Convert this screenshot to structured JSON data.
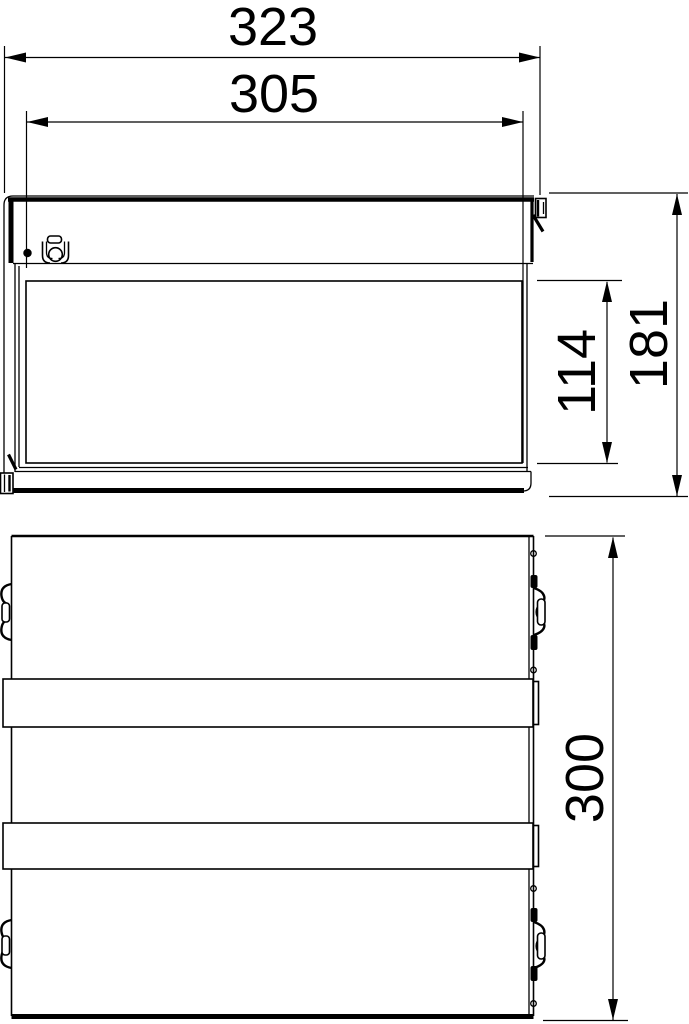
{
  "drawing": {
    "kind": "technical-dimension-drawing",
    "colors": {
      "line": "#000000",
      "background": "#ffffff"
    },
    "views": {
      "front": {
        "dimensions": {
          "overall_width": "323",
          "cover_width": "305",
          "opening_height": "114",
          "overall_height": "181"
        }
      },
      "bottom": {
        "dimensions": {
          "depth": "300"
        }
      }
    }
  }
}
